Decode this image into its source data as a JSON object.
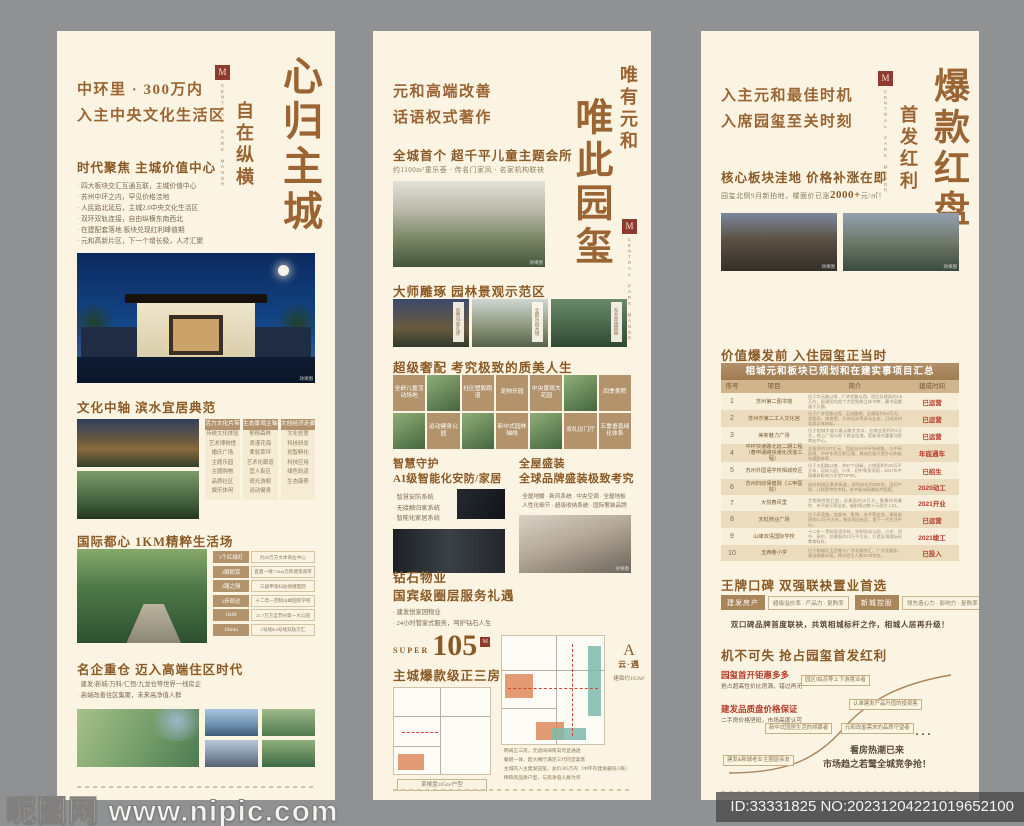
{
  "page": {
    "watermark": "昵图网 www.nipic.com",
    "id_label": "ID:33331825 NO:20231204221019652100",
    "photo_tag": "效果图",
    "colors": {
      "poster_bg": "#fcf4e2",
      "accent_brown": "#9a6433",
      "badge_tan": "#b2936c",
      "status_red": "#b43a28"
    }
  },
  "brand": {
    "seal_letter": "M",
    "name": "CENTRAL PARK MANOR"
  },
  "p1": {
    "title_main": "心归主城",
    "title_sub": "自在纵横",
    "headline1": "中环里 · 300万内",
    "headline2": "入主中央文化生活区",
    "s1_title": "时代聚焦 主城价值中心",
    "s1_bullets": [
      "四大板块交汇互通互联，主城价值中心",
      "苏州中环之内，罕见价格洼地",
      "人民路北延后，主城2.0中央文化生活区",
      "双环双轨连接，自由纵横东南西北",
      "在建配套落地 板块兑现红利峰值期",
      "元和高新片区，下一个增长极，人才汇聚"
    ],
    "s2_title": "文化中轴 滨水宜居典范",
    "s2_columns": [
      {
        "header": "活力文化片带",
        "items": [
          "传统文化体验",
          "艺术博物馆",
          "婚庆广场",
          "主题乐园",
          "主题购物",
          "品质社区",
          "娱乐休闲"
        ]
      },
      {
        "header": "生态景观主轴",
        "items": [
          "郁郁森林",
          "浪漫花海",
          "柔软草坪",
          "艺术化廊道",
          "宜人街区",
          "观光游憩",
          "运动健身"
        ]
      },
      {
        "header": "文创经济走廊",
        "items": [
          "文化创意",
          "科技研发",
          "创智孵化",
          "科技应用",
          "绿色轨道",
          "生态康养"
        ]
      }
    ],
    "s3_title": "国际都心 1KM精粹生活场",
    "s3_items": [
      {
        "badge": "1个红绿灯",
        "text": "约20万方文体商业中心"
      },
      {
        "badge": "1眼即赏",
        "text": "直面一线7.5km元和塘景观带"
      },
      {
        "badge": "1路之隔",
        "text": "三级甲等妇幼保健医院"
      },
      {
        "badge": "1步即达",
        "text": "十二年一贯制山峰国际学校"
      },
      {
        "badge": "1KM",
        "text": "21.7万方全苏州第一大公园"
      },
      {
        "badge": "10min",
        "text": "2号线&4号线双轨交汇"
      }
    ],
    "s4_title": "名企重仓 迈入高端住区时代",
    "s4_bullets": [
      "建发/新城/万科/仁恒/九龙仓等世界一线房企",
      "高端改善住区集聚，未来高净值人群"
    ]
  },
  "p2": {
    "title_side": "唯有元和",
    "title_main": "唯此园玺",
    "headline1": "元和高端改善",
    "headline2": "话语权式著作",
    "s1_title": "全城首个 超千平儿童主题会所",
    "s1_sub": "约1100m²童乐荟 · 传名门家风 · 名家机构联袂",
    "s2_title": "大师雕琢 园林景观示范区",
    "s2_labels": [
      "迎宾归家礼序",
      "全龄乐园大境",
      "东方意境园林"
    ],
    "s3_title": "超级奢配 考究极致的质美人生",
    "s3_grid": [
      {
        "type": "badge",
        "label": "全龄儿童活动场地"
      },
      {
        "type": "photo",
        "label": ""
      },
      {
        "type": "badge",
        "label": "社区塑胶跑道"
      },
      {
        "type": "badge",
        "label": "宠物乐园"
      },
      {
        "type": "badge",
        "label": "中央景观大花园"
      },
      {
        "type": "photo",
        "label": ""
      },
      {
        "type": "badge",
        "label": "四季美院"
      },
      {
        "type": "photo",
        "label": ""
      },
      {
        "type": "badge",
        "label": "运动健身公园"
      },
      {
        "type": "photo",
        "label": ""
      },
      {
        "type": "badge",
        "label": "新中式园林轴线"
      },
      {
        "type": "photo",
        "label": ""
      },
      {
        "type": "badge",
        "label": "双礼仪门厅"
      },
      {
        "type": "badge",
        "label": "五重垂直绿化体系"
      }
    ],
    "s4_left_title1": "智慧守护",
    "s4_left_title2": "AI级智能化安防/家居",
    "s4_left_bullets": [
      "智慧安防系统",
      "无接触归家系统",
      "智能化家居系统"
    ],
    "s4_right_title1": "全屋盛装",
    "s4_right_title2": "全球品牌盛装极致考究",
    "s4_right_bullets": [
      "全屋地暖 · 新风系统 · 中央空调 · 全屋地板",
      "人性化细节 · 超级收纳系统 · 国际奢装品牌"
    ],
    "s5_title1": "钻石物业",
    "s5_title2": "国宾级圈层服务礼遇",
    "s5_bullets": [
      "建发悦家园物业",
      "24小时管家式服务，呵护钻石人生"
    ],
    "s6_super": "SUPER",
    "s6_num": "105",
    "s6_sub": "主城爆款级正三房",
    "plan_caption": "某楼盘105m²户型",
    "plan_type": "A",
    "plan_name": "云·遇",
    "plan_area": "建面约105M²",
    "s6_bullets": [
      "明阔正三房，无遮阔绰南向尽显通透",
      "餐厨一体，超大横厅满足三代同堂宴客",
      "主城内入主建发园玺，总价305万内（中环内建发最低/3栋）",
      "稀缺高品质户型，与高净值人群为邻"
    ]
  },
  "p3": {
    "title_main": "爆款红盘",
    "title_side": "首发红利",
    "headline1": "入主元和最佳时机",
    "headline2": "入席园玺至关时刻",
    "s1_title": "核心板块洼地 价格补涨在即",
    "s1_sub_pre": "园玺北侧9月新拍地，楼面价已涨",
    "s1_sub_em": "2000+",
    "s1_sub_post": "元/㎡！",
    "s2_title": "价值爆发前 入住园玺正当时",
    "table": {
      "title": "相城元和板块已规划和在建实事项目汇总",
      "headers": [
        "序号",
        "项目",
        "简介",
        "建成时间"
      ],
      "rows": [
        {
          "no": "1",
          "name": "苏州第二图书馆",
          "desc": "位于华元路以南、广济北路以西，项目总建面约4.6万方，配建国内首个大型智能立体书库，藏书容量逾千万册。",
          "status": "已运营"
        },
        {
          "no": "2",
          "name": "苏州市第二工人文化宫",
          "desc": "位于广济北路以西、玉成路南，总建面约9.6万方，含剧场、体育馆、文体培训等多元业态，已成苏州北部文体地标。",
          "status": "已运营"
        },
        {
          "no": "3",
          "name": "美新魅力广场",
          "desc": "位于相城大道与嘉元路交叉口，总商业面积约3万方，地上广场与地下商业连通，是板块内重要邻里商业中心。",
          "status": "已运营"
        },
        {
          "no": "4",
          "name": "中环快速路北延二期工程（春申湖路快速化改造工程）",
          "desc": "总投资约137亿元，西起苏州中环快速路，与中环西线、中环东线互联互通，建成后极大提升元和板块通勤效率。",
          "status": "年底通车"
        },
        {
          "no": "5",
          "name": "苏州外国语学校相城校区",
          "desc": "位于太阳路以南，共57个班级，占地面积约10万平方米，设幼儿园、小学、初中等多学段，2017年中国最具影响力学堂TOP50。",
          "status": "已招生"
        },
        {
          "no": "6",
          "name": "苏州妇幼保健院（三甲医院）",
          "desc": "选址相城区黄桥街道，规划床位约800张，设妇产科、儿科等特色专科，补齐板块高端医疗配套。",
          "status": "2020动工"
        },
        {
          "no": "7",
          "name": "大悦春风里",
          "desc": "大悦城控股打造，总建面约10万方，集聚时尚餐饮、亲子娱乐等业态，辐射周边数十万居住人口。",
          "status": "2021开业"
        },
        {
          "no": "8",
          "name": "天虹商业广场",
          "desc": "位于采莲路，含超市、影院、亲子等业态，建筑面积约5.2万平方米，服务周边社区，是下一代生活中心。",
          "status": "已运营"
        },
        {
          "no": "9",
          "name": "山峰双语国际学校",
          "desc": "十二年一贯制双语学校，学制含幼儿园、小学、初中、高中，总建面约12万平方米，打造区域国际化教育标杆。",
          "status": "2021竣工"
        },
        {
          "no": "10",
          "name": "玉西巷小学",
          "desc": "位于相城区玉西巷与广济北路交汇，广济北路东，建设规模36班，预计招生人数1570余名。",
          "status": "已投入"
        }
      ]
    },
    "s3_title": "王牌口碑 双强联袂置业首选",
    "s3_badges": [
      {
        "name": "建发房产",
        "tags": "超级溢价率 · 产品力 · 复购率"
      },
      {
        "name": "新城控股",
        "tags": "领先造心力 · 影响力 · 复购率"
      }
    ],
    "s3_line": "双口碑品牌首度联袂，共筑相城标杆之作，相城人居再升级！",
    "s4_title": "机不可失 抢占园玺首发红利",
    "s4_point1": "园玺首开钜惠多多",
    "s4_point1_sub": "抢占超高性价比房源，错过再无",
    "s4_point2": "建发品质盘价格保证",
    "s4_point2_sub": "二手房价格坚挺，市场高度认可",
    "s4_curve_labels": [
      "建发&新城老业主圈层亲友",
      "新中式园居生活的倾慕者",
      "元和改善需求的品质守望者",
      "认准建发产品升值的投资客",
      "园区/姑苏等上下游置业者"
    ],
    "s4_dots": "···",
    "s4_end1": "看房热潮已来",
    "s4_end2": "市场趋之若鹜全城竞争抢！"
  }
}
